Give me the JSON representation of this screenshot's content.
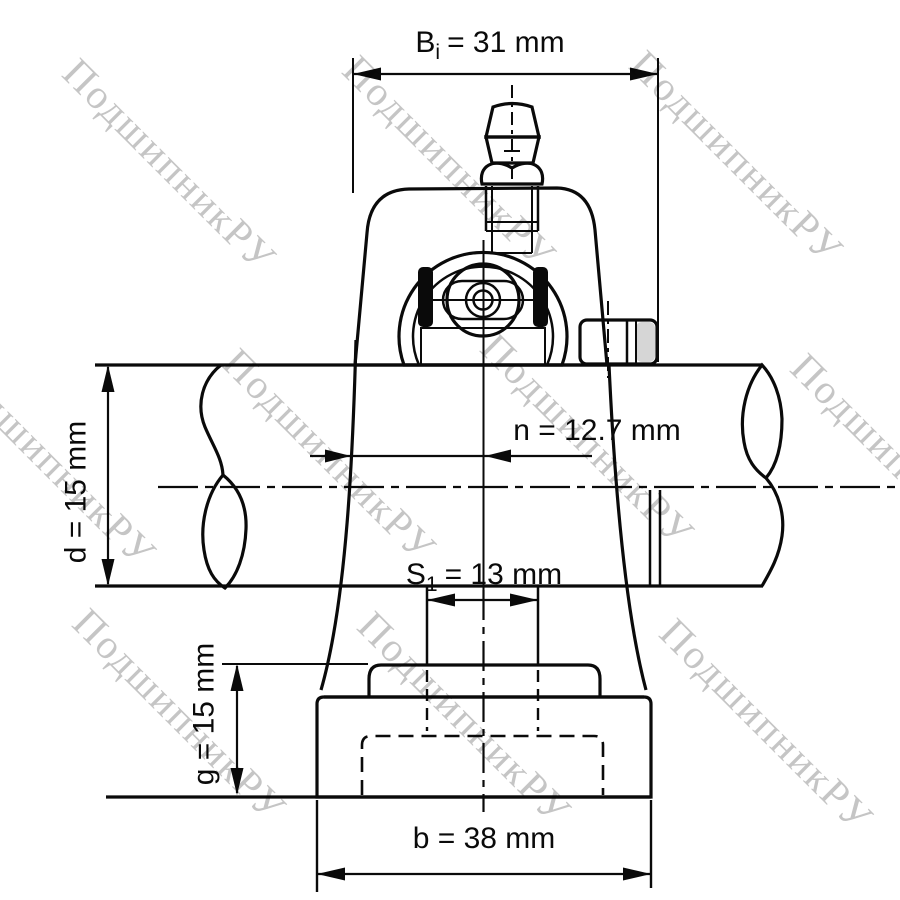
{
  "drawing_labels": {
    "bi": {
      "symbol": "B",
      "subscript": "i",
      "value": "= 31 mm",
      "mm": 31
    },
    "n": {
      "label": "n = 12.7 mm",
      "mm": 12.7
    },
    "d": {
      "label": "d = 15 mm",
      "mm": 15
    },
    "s1": {
      "symbol": "S",
      "subscript": "1",
      "value": "= 13 mm",
      "mm": 13
    },
    "g": {
      "label": "g = 15 mm",
      "mm": 15
    },
    "b": {
      "label": "b = 38 mm",
      "mm": 38
    }
  },
  "watermark": {
    "text": "ПодшипникРУ"
  },
  "colors": {
    "line": "#0a0a0a",
    "housing_gray": "#d6d6d6",
    "ring_gray": "#cfcfcf",
    "lens_gray": "#d9d9d9",
    "watermark_gray": "#c5c5c5",
    "background": "#ffffff"
  }
}
